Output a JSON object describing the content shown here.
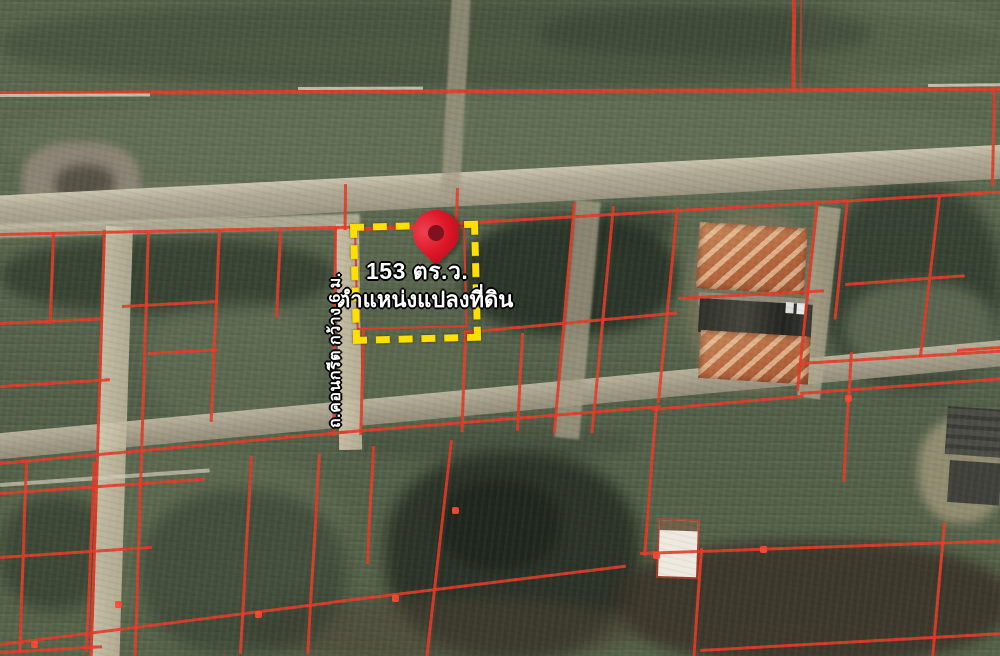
{
  "map": {
    "highlight": {
      "area_label": "153 ตร.ว.",
      "position_label": "ตำแหน่งแปลงที่ดิน"
    },
    "road_label": "ถ.คอนกรีต กว้าง 6 ม.",
    "marker": {
      "icon": "location-pin-icon"
    },
    "colors": {
      "parcel-line": "#e33b28",
      "highlight": "#ffdf00",
      "pin": "#dc1626",
      "road": "#b6ae99",
      "field": "#5c6950",
      "soil": "#4a4136"
    }
  }
}
